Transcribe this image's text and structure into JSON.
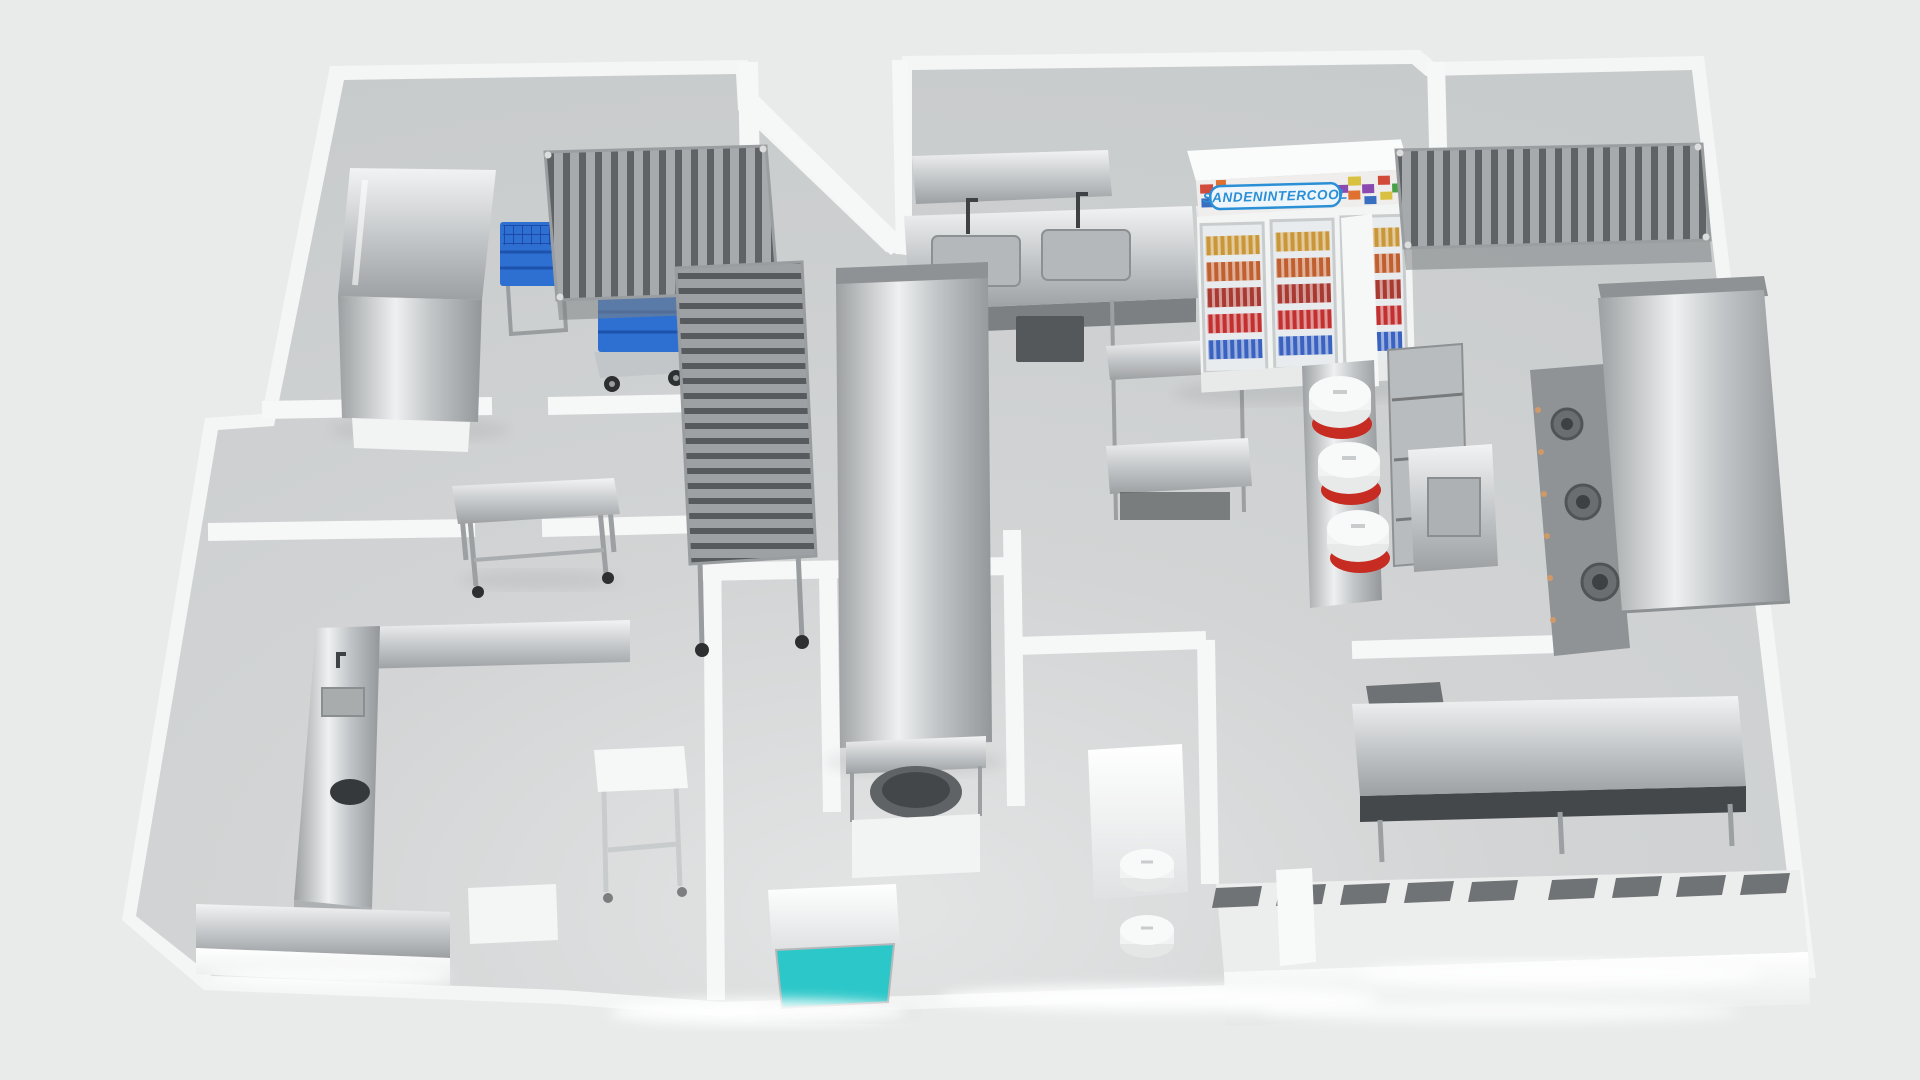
{
  "scene": {
    "type": "3d_floor_plan_render",
    "subject": "Commercial kitchen equipment layout, 3D top-down perspective render",
    "background_color": "#e9ebeb",
    "floor_color": "#d2d4d5",
    "wall_color": "#f5f6f6",
    "walkway_glow_color": "#ffffff"
  },
  "beverage_cooler": {
    "brand_text": "SANDENINTERCOOL",
    "doors_visible": 3,
    "shelf_rows_per_door": 5,
    "banner_blue": "#2b8fd6",
    "header_collage_colors": [
      "#d24a3a",
      "#4aa04a",
      "#3a6ec0",
      "#d8c040",
      "#8a4ab0",
      "#e07030"
    ],
    "shelf_row_colors": [
      "#c9973a",
      "#c06030",
      "#a93a32",
      "#c23030",
      "#3a62c0"
    ]
  },
  "accents": {
    "crate_blue": "#2e6fd2",
    "service_counter_teal": "#2cc7c9",
    "rice_cooker_red": "#c62c22",
    "stainless_steel": "#c6c9cb",
    "burner_dark": "#5f6264",
    "wheel_black": "#2e2f30"
  },
  "visible_equipment": [
    "hood-type dishwasher",
    "blue tray crates on wheeled trolley",
    "stainless slatted storage racks",
    "mobile stainless work table",
    "U-shaped pot-wash counter with sink and waste hole",
    "prep counters with twin sinks and faucets",
    "tall stainless extraction duct column",
    "kettle under stainless hood",
    "rice cookers with red bases",
    "SANDEN INTERCOOL glass-door beverage cooler",
    "wok range with burners and exhaust hood",
    "long pass-through serving counter",
    "teal-front service cabinet"
  ]
}
